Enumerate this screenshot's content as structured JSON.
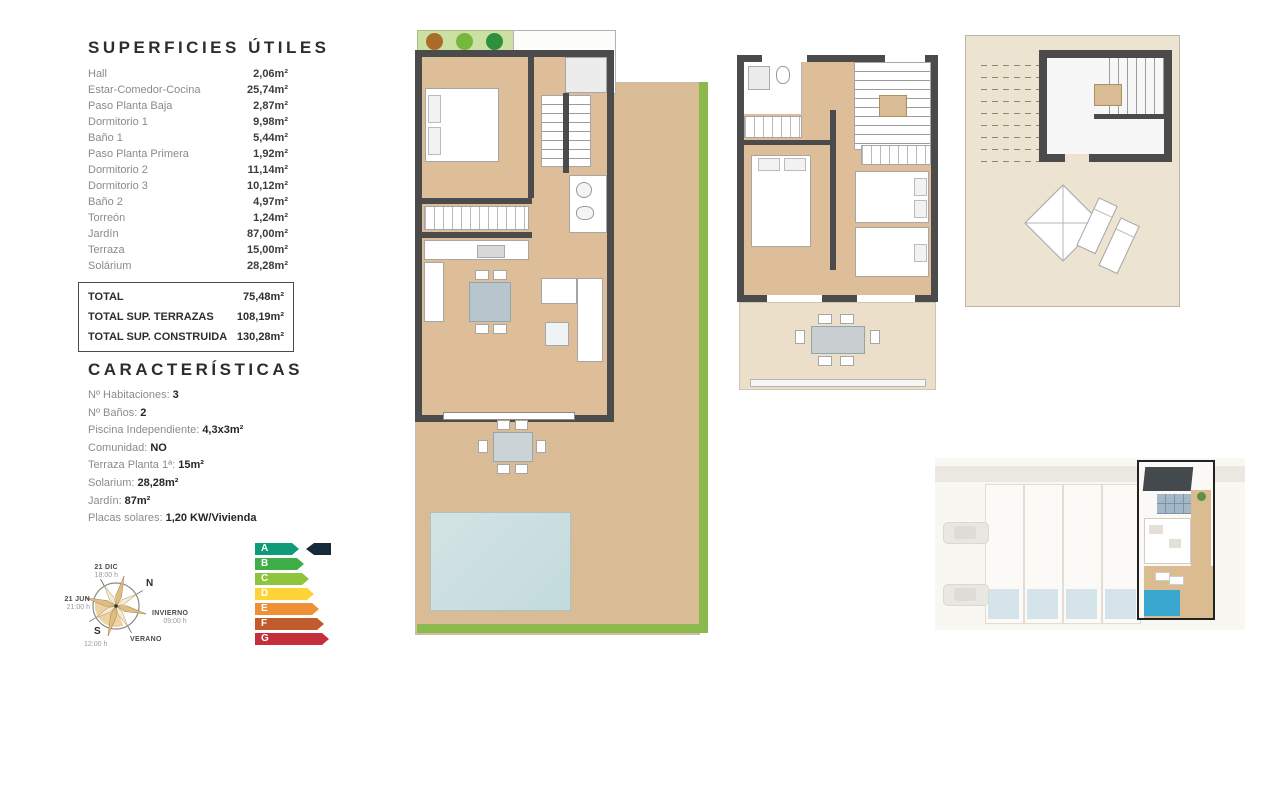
{
  "surfaces": {
    "title": "SUPERFICIES ÚTILES",
    "items": [
      {
        "label": "Hall",
        "value": "2,06m²"
      },
      {
        "label": "Estar-Comedor-Cocina",
        "value": "25,74m²"
      },
      {
        "label": "Paso Planta Baja",
        "value": "2,87m²"
      },
      {
        "label": "Dormitorio 1",
        "value": "9,98m²"
      },
      {
        "label": "Baño 1",
        "value": "5,44m²"
      },
      {
        "label": "Paso Planta Primera",
        "value": "1,92m²"
      },
      {
        "label": "Dormitorio 2",
        "value": "11,14m²"
      },
      {
        "label": "Dormitorio 3",
        "value": "10,12m²"
      },
      {
        "label": "Baño 2",
        "value": "4,97m²"
      },
      {
        "label": "Torreón",
        "value": "1,24m²"
      },
      {
        "label": "Jardín",
        "value": "87,00m²"
      },
      {
        "label": "Terraza",
        "value": "15,00m²"
      },
      {
        "label": "Solárium",
        "value": "28,28m²"
      }
    ],
    "totals": [
      {
        "label": "TOTAL",
        "value": "75,48m²"
      },
      {
        "label": "TOTAL SUP. TERRAZAS",
        "value": "108,19m²"
      },
      {
        "label": "TOTAL SUP. CONSTRUIDA",
        "value": "130,28m²"
      }
    ]
  },
  "characteristics": {
    "title": "CARACTERÍSTICAS",
    "items": [
      {
        "label": "Nº Habitaciones:",
        "value": "3"
      },
      {
        "label": "Nº Baños:",
        "value": "2"
      },
      {
        "label": "Piscina Independiente:",
        "value": "4,3x3m²"
      },
      {
        "label": "Comunidad:",
        "value": "NO"
      },
      {
        "label": "Terraza Planta 1ª:",
        "value": "15m²"
      },
      {
        "label": "Solarium:",
        "value": "28,28m²"
      },
      {
        "label": "Jardín:",
        "value": "87m²"
      },
      {
        "label": "Placas solares:",
        "value": "1,20 KW/Vivienda"
      }
    ]
  },
  "compass": {
    "north": "N",
    "south": "S",
    "dec_label": "21 DIC",
    "dec_time": "18:00 h",
    "jun_label": "21 JUN",
    "jun_time": "21:00 h",
    "winter_label": "INVIERNO",
    "winter_time": "09:00 h",
    "summer_label": "VERANO",
    "south_time": "12:00 h"
  },
  "energy": {
    "ratings": [
      {
        "letter": "A",
        "color": "#0d9b78"
      },
      {
        "letter": "B",
        "color": "#3fae49"
      },
      {
        "letter": "C",
        "color": "#8fc43e"
      },
      {
        "letter": "D",
        "color": "#fdd338"
      },
      {
        "letter": "E",
        "color": "#ee9036"
      },
      {
        "letter": "F",
        "color": "#bf5b2d"
      },
      {
        "letter": "G",
        "color": "#c52f3b"
      }
    ],
    "pointer_color": "#182a3a"
  },
  "colors": {
    "wall": "#4b4b4b",
    "wood_floor": "#ddbe98",
    "garden_deck": "#d9bb95",
    "terrace": "#ebdfc9",
    "grass": "#8cb94d",
    "pool": "#c9dee0",
    "site_pool": "#39a7d0"
  }
}
